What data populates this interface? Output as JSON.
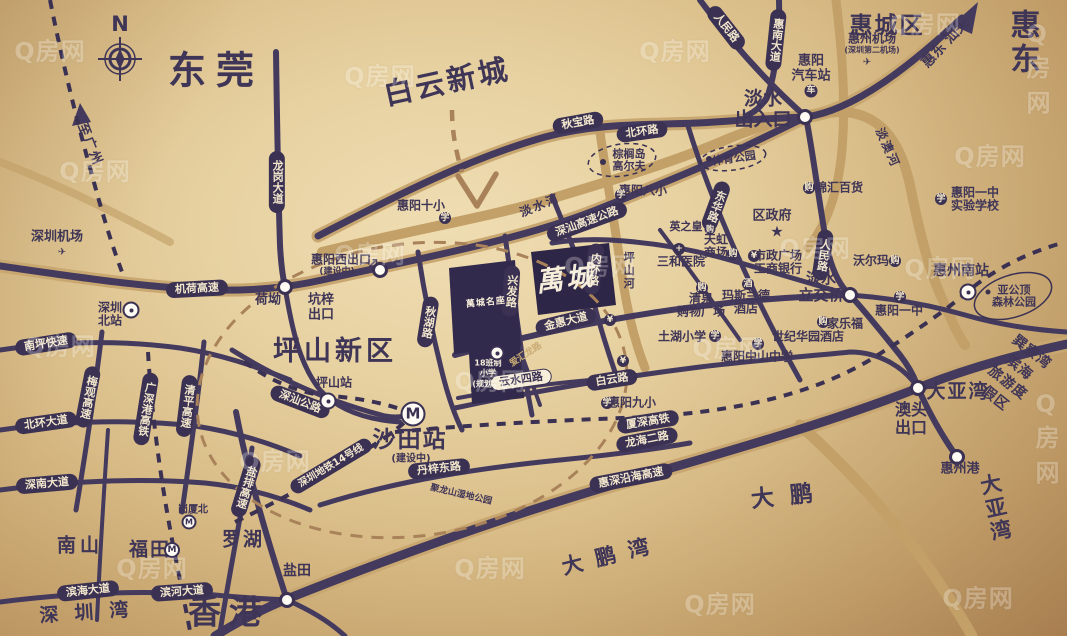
{
  "watermark": {
    "text": "Q房网",
    "positions": [
      [
        10,
        35
      ],
      [
        340,
        60
      ],
      [
        635,
        35
      ],
      [
        885,
        8
      ],
      [
        1000,
        55
      ],
      [
        55,
        155
      ],
      [
        330,
        238
      ],
      [
        560,
        250
      ],
      [
        775,
        232
      ],
      [
        950,
        140
      ],
      [
        20,
        330
      ],
      [
        235,
        445
      ],
      [
        450,
        365
      ],
      [
        688,
        332
      ],
      [
        900,
        252
      ],
      [
        450,
        552
      ],
      [
        680,
        588
      ],
      [
        938,
        582
      ],
      [
        1008,
        425
      ],
      [
        112,
        552
      ]
    ]
  },
  "compass": {
    "letter": "N"
  },
  "project": {
    "main_block_logo": "萬城",
    "phase_block_logo": "萬城名座",
    "planned_school": "18班制\n小学\n(规划中)",
    "block_road": "爱汇龙路"
  },
  "colors": {
    "road": "#433a5e",
    "pill": "#3a3153",
    "gold": "#c6a46c",
    "text": "#3f3557",
    "dashed_brown": "#a9825a"
  },
  "map": {
    "labels": [
      {
        "n": "city-dongguan",
        "t": "东莞",
        "x": 216,
        "y": 71,
        "fs": 38,
        "b": 1,
        "ls": 10
      },
      {
        "n": "area-baiyun-newtown",
        "t": "白云新城",
        "x": 447,
        "y": 82,
        "fs": 29,
        "b": 1,
        "r": -12,
        "ls": 3
      },
      {
        "n": "district-huicheng",
        "t": "惠城区",
        "x": 887,
        "y": 27,
        "fs": 23,
        "b": 1,
        "ls": 2
      },
      {
        "n": "city-huidong",
        "t": "惠东",
        "x": 1028,
        "y": 43,
        "fs": 30,
        "b": 1,
        "ls": 5
      },
      {
        "n": "direction-huidong-shantou",
        "t": "惠东 汕头",
        "x": 946,
        "y": 44,
        "fs": 14,
        "b": 1,
        "r": -47
      },
      {
        "n": "district-pingshan",
        "t": "坪山新区",
        "x": 335,
        "y": 352,
        "fs": 27,
        "b": 1,
        "ls": 4
      },
      {
        "n": "city-hongkong",
        "t": "香港",
        "x": 229,
        "y": 613,
        "fs": 33,
        "b": 1,
        "ls": 8
      },
      {
        "n": "area-nanshan",
        "t": "南山",
        "x": 80,
        "y": 546,
        "fs": 19,
        "b": 1,
        "ls": 4
      },
      {
        "n": "area-futian",
        "t": "福田",
        "x": 150,
        "y": 550,
        "fs": 19,
        "b": 1,
        "ls": 2
      },
      {
        "n": "area-luohu",
        "t": "罗湖",
        "x": 243,
        "y": 540,
        "fs": 19,
        "b": 1,
        "ls": 2
      },
      {
        "n": "area-yantian",
        "t": "盐田",
        "x": 297,
        "y": 572,
        "fs": 14,
        "b": 1
      },
      {
        "n": "bay-shenzhen",
        "t": "深圳湾",
        "x": 92,
        "y": 613,
        "fs": 19,
        "ls": 16,
        "r": -4
      },
      {
        "n": "bay-dapeng",
        "t": "大鹏湾",
        "x": 612,
        "y": 556,
        "fs": 21,
        "ls": 13,
        "r": -14
      },
      {
        "n": "area-dapeng",
        "t": "大鹏",
        "x": 790,
        "y": 497,
        "fs": 23,
        "ls": 16,
        "r": -6
      },
      {
        "n": "area-dayawan",
        "t": "大亚湾",
        "x": 958,
        "y": 392,
        "fs": 19,
        "b": 1,
        "ls": 2
      },
      {
        "n": "bay-daya",
        "t": "大亚湾",
        "x": 1003,
        "y": 507,
        "fs": 21,
        "ls": 14,
        "r": -12
      },
      {
        "n": "exit-danshui",
        "t": "淡水\n出入口",
        "x": 763,
        "y": 110,
        "fs": 19,
        "b": 1
      },
      {
        "n": "station-shatian",
        "t": "沙田站",
        "x": 410,
        "y": 441,
        "fs": 23,
        "b": 1,
        "ls": 2
      },
      {
        "n": "station-shatian-note",
        "t": "(建设中)",
        "x": 411,
        "y": 459,
        "fs": 10
      },
      {
        "n": "exit-aotou",
        "t": "澳头\n出口",
        "x": 911,
        "y": 419,
        "fs": 16,
        "b": 1
      },
      {
        "n": "direction-guangzhou",
        "t": "至广州",
        "x": 89,
        "y": 145,
        "fs": 13,
        "r": 68,
        "ls": 2
      },
      {
        "n": "exit-kengzi",
        "t": "坑梓\n出口",
        "x": 321,
        "y": 308,
        "fs": 13,
        "b": 1
      },
      {
        "n": "exit-huiyangxi",
        "t": "惠阳西出口",
        "x": 341,
        "y": 260,
        "fs": 12,
        "b": 1
      },
      {
        "n": "exit-huiyangxi-note",
        "t": "(建设中)",
        "x": 337,
        "y": 272,
        "fs": 9
      },
      {
        "n": "exit-huiyangxi-arrow",
        "t": "↗",
        "x": 373,
        "y": 265,
        "fs": 14,
        "b": 1
      },
      {
        "n": "interchange-danshui",
        "t": "淡水\n立交桥",
        "x": 821,
        "y": 287,
        "fs": 15,
        "b": 1
      },
      {
        "n": "port-huizhou",
        "t": "惠州港",
        "x": 960,
        "y": 470,
        "fs": 13,
        "b": 1
      },
      {
        "n": "station-huizhou-south",
        "t": "惠州南站",
        "x": 961,
        "y": 272,
        "fs": 14,
        "b": 1
      },
      {
        "n": "resort-xunliaowan",
        "t": "巽寮湾滨海\n旅游度假区",
        "x": 1013,
        "y": 376,
        "fs": 14,
        "r": 38,
        "lh": 1.4,
        "ls": 1
      },
      {
        "n": "park-yagongding",
        "t": "亚公顶\n森林公园",
        "x": 1014,
        "y": 297,
        "fs": 11
      },
      {
        "n": "river-danshui",
        "t": "淡水河",
        "x": 540,
        "y": 206,
        "fs": 12,
        "r": -22,
        "ls": 2
      },
      {
        "n": "river-danao",
        "t": "淡澳河",
        "x": 887,
        "y": 148,
        "fs": 12,
        "r": 66,
        "ls": 2
      },
      {
        "n": "river-pingshan",
        "t": "坪山河",
        "x": 628,
        "y": 271,
        "fs": 11,
        "v": 1,
        "ls": 2
      },
      {
        "n": "park-julongshan",
        "t": "聚龙山湿地公园",
        "x": 461,
        "y": 495,
        "fs": 9,
        "r": 13
      },
      {
        "n": "station-gangxiabei",
        "t": "岗厦北",
        "x": 193,
        "y": 510,
        "fs": 10
      },
      {
        "n": "airport-huizhou",
        "t": "惠州机场",
        "x": 872,
        "y": 39,
        "fs": 12,
        "b": 1
      },
      {
        "n": "airport-huizhou-note",
        "t": "(深圳第二机场)",
        "x": 872,
        "y": 51,
        "fs": 8
      },
      {
        "n": "station-huiyang-bus",
        "t": "惠阳\n汽车站",
        "x": 811,
        "y": 69,
        "fs": 13,
        "b": 1
      },
      {
        "n": "poi-district-government",
        "t": "区政府",
        "x": 772,
        "y": 217,
        "fs": 13,
        "b": 1
      },
      {
        "n": "government-star-icon",
        "t": "★",
        "x": 777,
        "y": 232,
        "fs": 15
      },
      {
        "n": "poi-walmart",
        "t": "沃尔玛",
        "x": 871,
        "y": 261,
        "fs": 12,
        "b": 1
      },
      {
        "n": "poi-jinhui-department",
        "t": "锦汇百货",
        "x": 839,
        "y": 188,
        "fs": 12,
        "b": 1
      },
      {
        "n": "poi-yingzhihuang",
        "t": "英之皇",
        "x": 686,
        "y": 227,
        "fs": 11,
        "b": 1
      },
      {
        "n": "poi-rainbow-mall",
        "t": "天虹\n商场",
        "x": 716,
        "y": 247,
        "fs": 12,
        "b": 1
      },
      {
        "n": "poi-sanhe-hospital",
        "t": "三和医院",
        "x": 681,
        "y": 262,
        "fs": 12,
        "b": 1
      },
      {
        "n": "poi-civic-square-icbc",
        "t": "市政广场\n工商银行",
        "x": 778,
        "y": 263,
        "fs": 12,
        "b": 1
      },
      {
        "n": "poi-qingquan-mall",
        "t": "清泉\n购物广场",
        "x": 701,
        "y": 306,
        "fs": 12,
        "b": 1
      },
      {
        "n": "poi-maslande-hotel",
        "t": "玛斯兰德\n酒店",
        "x": 746,
        "y": 303,
        "fs": 12,
        "b": 1
      },
      {
        "n": "poi-carrefour",
        "t": "家乐福",
        "x": 845,
        "y": 324,
        "fs": 12,
        "b": 1
      },
      {
        "n": "poi-century-garden-hotel",
        "t": "世纪华园酒店",
        "x": 808,
        "y": 337,
        "fs": 12,
        "b": 1
      },
      {
        "n": "school-tuhu",
        "t": "土湖小学",
        "x": 682,
        "y": 337,
        "fs": 12,
        "b": 1
      },
      {
        "n": "school-zhongshan",
        "t": "惠阳中山中学",
        "x": 757,
        "y": 357,
        "fs": 12,
        "b": 1
      },
      {
        "n": "school-huiyang-9",
        "t": "惠阳九小",
        "x": 632,
        "y": 403,
        "fs": 12,
        "b": 1
      },
      {
        "n": "school-huiyang-8",
        "t": "惠阳八小",
        "x": 643,
        "y": 191,
        "fs": 12,
        "b": 1
      },
      {
        "n": "school-huiyang-10",
        "t": "惠阳十小",
        "x": 421,
        "y": 206,
        "fs": 12,
        "b": 1
      },
      {
        "n": "school-huiyang-1",
        "t": "惠阳一中",
        "x": 899,
        "y": 311,
        "fs": 12,
        "b": 1
      },
      {
        "n": "school-huiyang-1-experimental",
        "t": "惠阳一中\n实验学校",
        "x": 975,
        "y": 200,
        "fs": 12,
        "b": 1
      },
      {
        "n": "poi-palm-island-golf",
        "t": "棕榈岛\n高尔夫",
        "x": 629,
        "y": 161,
        "fs": 11
      },
      {
        "n": "park-sports",
        "t": "体育公园",
        "x": 734,
        "y": 159,
        "fs": 11,
        "r": -8
      },
      {
        "n": "airport-shenzhen",
        "t": "深圳机场",
        "x": 57,
        "y": 238,
        "fs": 13,
        "b": 1
      },
      {
        "n": "station-shenzhen-north",
        "t": "深圳\n北站",
        "x": 110,
        "y": 315,
        "fs": 12,
        "b": 1
      },
      {
        "n": "station-pingshan",
        "t": "坪山站",
        "x": 334,
        "y": 383,
        "fs": 12,
        "b": 1
      },
      {
        "n": "node-heao",
        "t": "荷坳",
        "x": 268,
        "y": 301,
        "fs": 13,
        "b": 1
      },
      {
        "n": "project-logo",
        "t": "萬城",
        "x": 566,
        "y": 280,
        "fs": 27,
        "w": 1,
        "r": -7,
        "ls": 3,
        "k": "callig"
      },
      {
        "n": "project-planned-school",
        "t": "18班制\n小学\n(规划中)",
        "x": 488,
        "y": 374,
        "fs": 8,
        "w": 1,
        "lh": 1.3
      },
      {
        "n": "road-aihuilong",
        "t": "爱汇龙路",
        "x": 526,
        "y": 355,
        "fs": 9,
        "r": -33,
        "c": "#c9ab74"
      },
      {
        "n": "project-phase-logo",
        "t": "萬城名座",
        "x": 486,
        "y": 303,
        "fs": 9,
        "w": 1,
        "r": -6,
        "ls": 1
      }
    ],
    "pills": [
      {
        "n": "road-qiubao",
        "t": "秋宝路",
        "x": 578,
        "y": 123,
        "r": -10
      },
      {
        "n": "road-beihuan",
        "t": "北环路",
        "x": 642,
        "y": 132,
        "r": -8
      },
      {
        "n": "road-shenshan-expressway",
        "t": "深汕高速公路",
        "x": 587,
        "y": 222,
        "r": -20
      },
      {
        "n": "road-longgang-avenue",
        "t": "龙岗大道",
        "x": 277,
        "y": 182,
        "v": 1
      },
      {
        "n": "road-renmin-north",
        "t": "人民路",
        "x": 726,
        "y": 28,
        "r": 52
      },
      {
        "n": "road-huinan-avenue",
        "t": "惠南大道",
        "x": 776,
        "y": 40,
        "v": 1,
        "r": 6
      },
      {
        "n": "road-renmin",
        "t": "人民路",
        "x": 823,
        "y": 255,
        "v": 1,
        "r": 8
      },
      {
        "n": "road-donghua",
        "t": "东华路",
        "x": 716,
        "y": 206,
        "v": 1,
        "r": 20
      },
      {
        "n": "road-jihe-expressway",
        "t": "机荷高速",
        "x": 197,
        "y": 289,
        "r": -3
      },
      {
        "n": "road-nanping-expressway",
        "t": "南坪快速",
        "x": 46,
        "y": 344,
        "r": -9
      },
      {
        "n": "road-meiguan-expressway",
        "t": "梅观高速",
        "x": 88,
        "y": 397,
        "v": 1,
        "r": 11
      },
      {
        "n": "rail-guangshengang",
        "t": "广深港高铁",
        "x": 146,
        "y": 409,
        "v": 1,
        "r": 9
      },
      {
        "n": "road-qingping-expressway",
        "t": "清平高速",
        "x": 187,
        "y": 406,
        "v": 1,
        "r": 7
      },
      {
        "n": "road-beihuan-avenue",
        "t": "北环大道",
        "x": 46,
        "y": 423,
        "r": -8
      },
      {
        "n": "road-shennan-avenue",
        "t": "深南大道",
        "x": 47,
        "y": 484,
        "r": -5
      },
      {
        "n": "road-yanpai-expressway",
        "t": "盐排高速",
        "x": 246,
        "y": 487,
        "v": 1,
        "r": 17
      },
      {
        "n": "road-binhai-avenue",
        "t": "滨海大道",
        "x": 88,
        "y": 591,
        "r": -6
      },
      {
        "n": "road-binhe-avenue",
        "t": "滨河大道",
        "x": 182,
        "y": 592,
        "r": -4
      },
      {
        "n": "rail-metro-line14",
        "t": "深圳地铁14号线",
        "x": 331,
        "y": 466,
        "r": -31,
        "fs": 10
      },
      {
        "n": "road-shenshan",
        "t": "深汕公路",
        "x": 300,
        "y": 402,
        "r": 21
      },
      {
        "n": "road-danzi-east",
        "t": "丹梓东路",
        "x": 439,
        "y": 469,
        "r": -6
      },
      {
        "n": "road-huishen-coastal",
        "t": "惠深沿海高速",
        "x": 631,
        "y": 478,
        "r": -11
      },
      {
        "n": "rail-xiashen",
        "t": "厦深高铁",
        "x": 648,
        "y": 422,
        "r": -9
      },
      {
        "n": "road-longhai-2",
        "t": "龙海二路",
        "x": 647,
        "y": 440,
        "r": -11
      },
      {
        "n": "road-baiyun",
        "t": "白云路",
        "x": 612,
        "y": 380,
        "r": -9
      },
      {
        "n": "road-jinhui-avenue",
        "t": "金惠大道",
        "x": 566,
        "y": 322,
        "r": -14
      },
      {
        "n": "road-xingfa",
        "t": "兴发路",
        "x": 511,
        "y": 291,
        "v": 1,
        "r": 4
      },
      {
        "n": "road-qiuhu",
        "t": "秋湖路",
        "x": 428,
        "y": 322,
        "v": 1,
        "r": 9
      },
      {
        "n": "road-neihuan",
        "t": "内环路",
        "x": 594,
        "y": 269,
        "v": 1,
        "r": 7
      },
      {
        "n": "road-yunshui-4",
        "t": "云水四路",
        "x": 521,
        "y": 380,
        "r": -8,
        "light": 1
      }
    ],
    "icons": [
      {
        "n": "school-icon",
        "g": "学",
        "x": 445,
        "y": 218,
        "k": "circle",
        "s": 12
      },
      {
        "n": "school-icon",
        "g": "学",
        "x": 621,
        "y": 195,
        "k": "circle",
        "s": 12
      },
      {
        "n": "school-icon",
        "g": "学",
        "x": 607,
        "y": 403,
        "k": "circle",
        "s": 12
      },
      {
        "n": "school-icon",
        "g": "学",
        "x": 715,
        "y": 336,
        "k": "circle",
        "s": 12
      },
      {
        "n": "school-icon",
        "g": "学",
        "x": 758,
        "y": 344,
        "k": "circle",
        "s": 12
      },
      {
        "n": "school-icon",
        "g": "学",
        "x": 900,
        "y": 297,
        "k": "circle",
        "s": 12
      },
      {
        "n": "school-icon",
        "g": "学",
        "x": 941,
        "y": 199,
        "k": "circle",
        "s": 12
      },
      {
        "n": "bank-icon",
        "g": "¥",
        "x": 610,
        "y": 320,
        "k": "circle",
        "s": 12
      },
      {
        "n": "bank-icon",
        "g": "¥",
        "x": 623,
        "y": 361,
        "k": "circle",
        "s": 12
      },
      {
        "n": "bank-icon",
        "g": "¥",
        "x": 754,
        "y": 256,
        "k": "circle",
        "s": 12
      },
      {
        "n": "hospital-icon",
        "g": "+",
        "x": 679,
        "y": 249,
        "k": "circle",
        "s": 12
      },
      {
        "n": "mall-icon",
        "g": "购",
        "x": 733,
        "y": 254,
        "k": "circle",
        "s": 12
      },
      {
        "n": "mall-icon",
        "g": "购",
        "x": 702,
        "y": 288,
        "k": "circle",
        "s": 12
      },
      {
        "n": "mall-icon",
        "g": "购",
        "x": 809,
        "y": 188,
        "k": "circle",
        "s": 12
      },
      {
        "n": "mall-icon",
        "g": "购",
        "x": 710,
        "y": 229,
        "k": "circle",
        "s": 11
      },
      {
        "n": "mall-icon",
        "g": "购",
        "x": 895,
        "y": 261,
        "k": "circle",
        "s": 12
      },
      {
        "n": "mall-icon",
        "g": "购",
        "x": 823,
        "y": 322,
        "k": "circle",
        "s": 12
      },
      {
        "n": "hotel-icon",
        "g": "酒",
        "x": 748,
        "y": 284,
        "k": "circle",
        "s": 12
      },
      {
        "n": "bus-icon",
        "g": "车",
        "x": 811,
        "y": 91,
        "k": "circle",
        "s": 13
      },
      {
        "n": "train-icon",
        "g": "",
        "x": 131,
        "y": 310,
        "k": "rail",
        "s": 13
      },
      {
        "n": "train-icon",
        "g": "",
        "x": 328,
        "y": 401,
        "k": "rail",
        "s": 13
      },
      {
        "n": "train-icon",
        "g": "",
        "x": 968,
        "y": 292,
        "k": "rail",
        "s": 13
      },
      {
        "n": "metro-icon",
        "g": "M",
        "x": 413,
        "y": 414,
        "k": "metro",
        "s": 21
      },
      {
        "n": "metro-icon",
        "g": "M",
        "x": 172,
        "y": 550,
        "k": "metro",
        "s": 12
      },
      {
        "n": "metro-icon",
        "g": "M",
        "x": 189,
        "y": 522,
        "k": "metro",
        "s": 11
      },
      {
        "n": "plane-icon",
        "g": "✈",
        "x": 62,
        "y": 253,
        "k": "plain",
        "s": 14
      },
      {
        "n": "plane-icon",
        "g": "✈",
        "x": 867,
        "y": 63,
        "k": "plain",
        "s": 14
      },
      {
        "n": "golf-dot-icon",
        "g": "",
        "x": 603,
        "y": 162,
        "k": "dot",
        "s": 6
      },
      {
        "n": "park-dot-icon",
        "g": "",
        "x": 709,
        "y": 159,
        "k": "dot",
        "s": 6
      },
      {
        "n": "park-dot-icon",
        "g": "",
        "x": 988,
        "y": 292,
        "k": "dot",
        "s": 5
      },
      {
        "n": "school-icon",
        "g": "",
        "x": 497,
        "y": 353,
        "k": "rail",
        "s": 11
      }
    ],
    "nodes": [
      {
        "n": "junction-danshui-entrance",
        "x": 805,
        "y": 117
      },
      {
        "n": "junction-danshui-interchange",
        "x": 850,
        "y": 295
      },
      {
        "n": "junction-heao",
        "x": 285,
        "y": 287
      },
      {
        "n": "junction-huiyangxi",
        "x": 380,
        "y": 270
      },
      {
        "n": "junction-yantian",
        "x": 287,
        "y": 600
      },
      {
        "n": "junction-huizhou-port",
        "x": 957,
        "y": 457
      },
      {
        "n": "junction-dayawan",
        "x": 918,
        "y": 388
      }
    ]
  }
}
